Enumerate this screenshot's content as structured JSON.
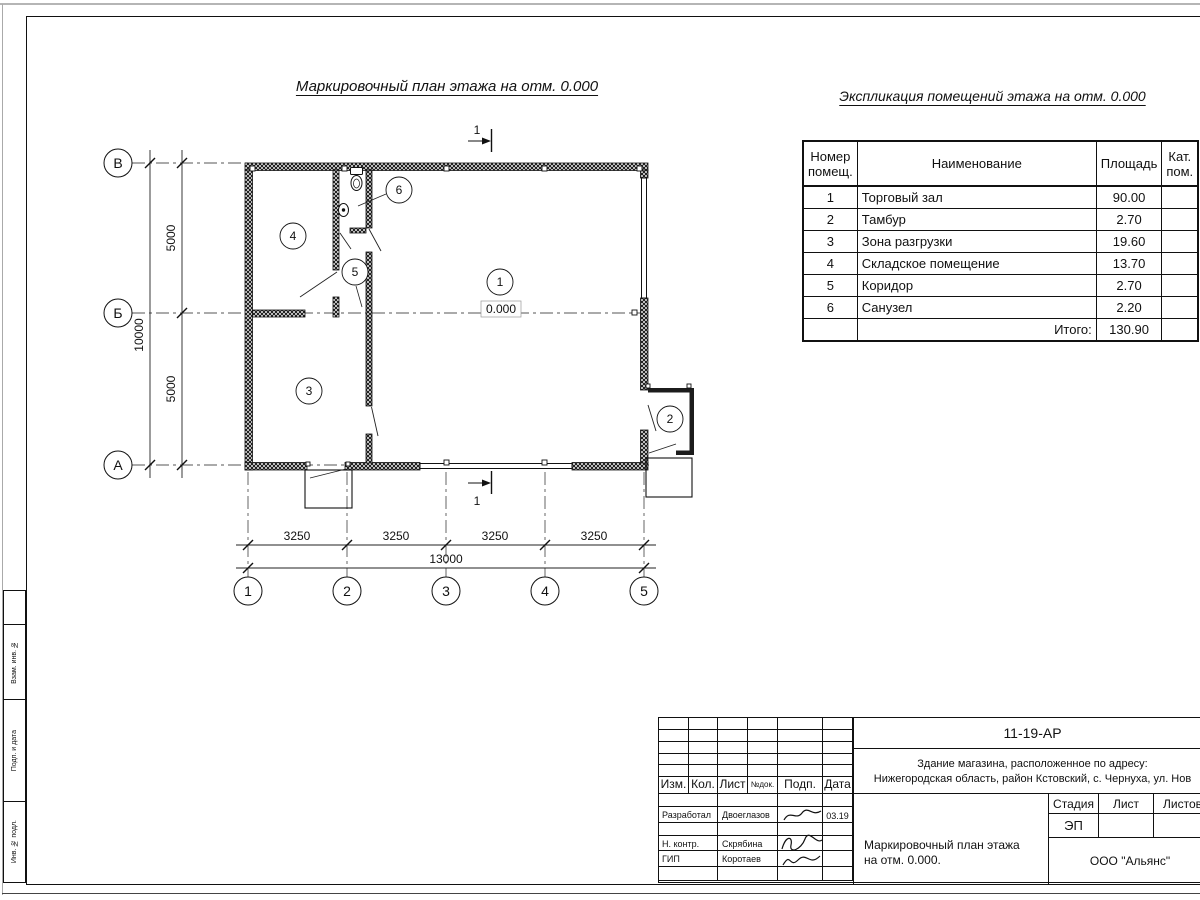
{
  "titles": {
    "plan": "Маркировочный план этажа на отм. 0.000",
    "explication": "Экспликация помещений этажа на отм. 0.000"
  },
  "explication": {
    "col_number": "Номер\nпомещ.",
    "col_name": "Наименование",
    "col_area": "Площадь",
    "col_cat": "Кат.\nпом.",
    "rows": [
      {
        "n": "1",
        "name": "Торговый зал",
        "area": "90.00"
      },
      {
        "n": "2",
        "name": "Тамбур",
        "area": "2.70"
      },
      {
        "n": "3",
        "name": "Зона разгрузки",
        "area": "19.60"
      },
      {
        "n": "4",
        "name": "Складское помещение",
        "area": "13.70"
      },
      {
        "n": "5",
        "name": "Коридор",
        "area": "2.70"
      },
      {
        "n": "6",
        "name": "Санузел",
        "area": "2.20"
      }
    ],
    "total_label": "Итого:",
    "total": "130.90"
  },
  "plan": {
    "section_label": "1",
    "elevation": "0.000",
    "rooms": {
      "r1": "1",
      "r2": "2",
      "r3": "3",
      "r4": "4",
      "r5": "5",
      "r6": "6"
    },
    "axes": {
      "hा": "",
      "h1": "В",
      "h2": "Б",
      "h3": "А",
      "v1": "1",
      "v2": "2",
      "v3": "3",
      "v4": "4",
      "v5": "5"
    },
    "dims": {
      "left1": "5000",
      "left2": "5000",
      "left_total": "10000",
      "bot1": "3250",
      "bot2": "3250",
      "bot3": "3250",
      "bot4": "3250",
      "bot_total": "13000"
    }
  },
  "titleblock": {
    "doc_number": "11-19-АР",
    "address_line1": "Здание магазина, расположенное по адресу:",
    "address_line2": "Нижегородская область, район Кстовский, с. Чернуха, ул. Нов",
    "cols": {
      "izm": "Изм.",
      "kol": "Кол.",
      "list": "Лист",
      "ndok": "№док.",
      "podp": "Подп.",
      "data": "Дата"
    },
    "stage_label": "Стадия",
    "sheet_label": "Лист",
    "sheets_label": "Листов",
    "stage_value": "ЭП",
    "rows": [
      {
        "role": "Разработал",
        "name": "Двоеглазов",
        "date": "03.19"
      },
      {
        "role": "Н. контр.",
        "name": "Скрябина",
        "date": ""
      },
      {
        "role": "ГИП",
        "name": "Коротаев",
        "date": ""
      }
    ],
    "drawing_title_line1": "Маркировочный план этажа",
    "drawing_title_line2": "на отм. 0.000.",
    "company": "ООО \"Альянс\""
  },
  "margin": {
    "labels": [
      "Взам. инв. №",
      "Подп. и дата",
      "Инв. № подл."
    ]
  }
}
